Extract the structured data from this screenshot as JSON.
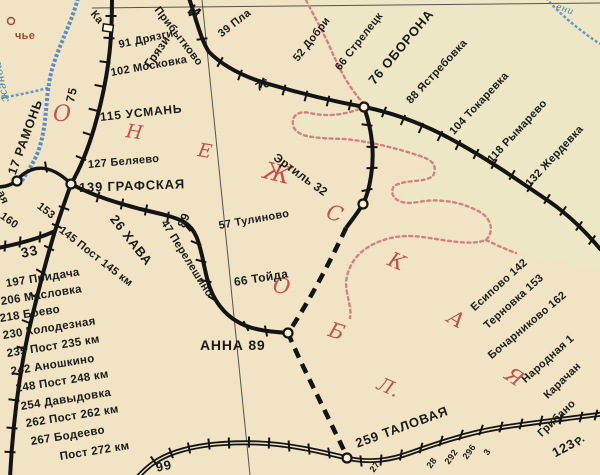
{
  "palette": {
    "background": "#f1e4c4",
    "railway_black": "#141414",
    "oblast_boundary_pink": "#d4827f",
    "river_blue": "#4a84c4",
    "oblast_letters_red": "#c0524e",
    "settlement_red": "#a34a33",
    "neighbor_region_tint": "#e9edcc"
  },
  "map": {
    "description": "Railway map fragment, Voronezh oblast",
    "labels": [
      {
        "t": "О",
        "x": 53,
        "y": 104,
        "r": 0,
        "s": 22,
        "c": "red",
        "n": "oblast-letter"
      },
      {
        "t": "Н",
        "x": 126,
        "y": 122,
        "r": 8,
        "s": 19,
        "c": "red",
        "n": "oblast-letter"
      },
      {
        "t": "Е",
        "x": 198,
        "y": 141,
        "r": 10,
        "s": 19,
        "c": "red",
        "n": "oblast-letter"
      },
      {
        "t": "Ж",
        "x": 264,
        "y": 158,
        "r": 14,
        "s": 24,
        "c": "red",
        "n": "oblast-letter"
      },
      {
        "t": "С",
        "x": 327,
        "y": 201,
        "r": 18,
        "s": 21,
        "c": "red",
        "n": "oblast-letter"
      },
      {
        "t": "К",
        "x": 389,
        "y": 248,
        "r": 24,
        "s": 21,
        "c": "red",
        "n": "oblast-letter"
      },
      {
        "t": "А",
        "x": 449,
        "y": 305,
        "r": 30,
        "s": 21,
        "c": "red",
        "n": "oblast-letter"
      },
      {
        "t": "Я",
        "x": 507,
        "y": 362,
        "r": 34,
        "s": 21,
        "c": "red",
        "n": "oblast-letter"
      },
      {
        "t": "О",
        "x": 273,
        "y": 275,
        "r": 8,
        "s": 21,
        "c": "red",
        "n": "oblast-letter"
      },
      {
        "t": "Б",
        "x": 329,
        "y": 319,
        "r": 18,
        "s": 21,
        "c": "red",
        "n": "oblast-letter"
      },
      {
        "t": "Л.",
        "x": 378,
        "y": 374,
        "r": 24,
        "s": 19,
        "c": "red",
        "n": "oblast-letter"
      },
      {
        "t": "чье",
        "x": 15,
        "y": 31,
        "r": 0,
        "s": 11,
        "c": "brown",
        "n": "settlement-label"
      },
      {
        "t": "ронеж",
        "x": -2,
        "y": 56,
        "r": 78,
        "s": 11,
        "c": "blue",
        "n": "river-label"
      },
      {
        "t": "ени",
        "x": 556,
        "y": 3,
        "r": 18,
        "s": 9,
        "c": "blue",
        "n": "river-label"
      },
      {
        "t": "Прибытково",
        "x": 156,
        "y": 3,
        "r": 52,
        "s": 11,
        "n": "station-label"
      },
      {
        "t": "И",
        "x": 189,
        "y": 1,
        "r": 38,
        "s": 16,
        "b": true,
        "n": "direction-label"
      },
      {
        "t": "Ка",
        "x": 92,
        "y": 7,
        "r": 50,
        "s": 11,
        "n": "direction-label"
      },
      {
        "t": "Грязи",
        "x": 147,
        "y": 60,
        "r": -55,
        "s": 12,
        "n": "direction-label"
      },
      {
        "t": "75",
        "x": 70,
        "y": 96,
        "r": -78,
        "s": 12,
        "b": true,
        "n": "km-marker"
      },
      {
        "t": "91 Дрязги",
        "x": 119,
        "y": 40,
        "r": -12,
        "s": 11,
        "n": "station-label"
      },
      {
        "t": "102 Московка",
        "x": 111,
        "y": 68,
        "r": -10,
        "s": 11,
        "n": "station-label"
      },
      {
        "t": "115 УСМАНЬ",
        "x": 100,
        "y": 111,
        "r": -6,
        "s": 12,
        "b": true,
        "n": "station-label"
      },
      {
        "t": "127 Беляево",
        "x": 88,
        "y": 160,
        "r": -5,
        "s": 11,
        "n": "station-label"
      },
      {
        "t": "139 ГРАФСКАЯ",
        "x": 79,
        "y": 181,
        "r": -2,
        "s": 13,
        "b": true,
        "n": "station-label"
      },
      {
        "t": "17 РАМОНЬ",
        "x": 12,
        "y": 168,
        "r": -70,
        "s": 12.5,
        "b": true,
        "n": "station-label"
      },
      {
        "t": "39 Пла",
        "x": 220,
        "y": 30,
        "r": -38,
        "s": 11,
        "n": "station-label"
      },
      {
        "t": "52 Добри",
        "x": 296,
        "y": 55,
        "r": -52,
        "s": 11,
        "n": "station-label"
      },
      {
        "t": "66 Стрелецк",
        "x": 338,
        "y": 64,
        "r": -52,
        "s": 11,
        "n": "station-label"
      },
      {
        "t": "76",
        "x": 256,
        "y": 82,
        "r": -25,
        "s": 12,
        "b": true,
        "n": "km-marker"
      },
      {
        "t": "76 ОБОРОНА",
        "x": 371,
        "y": 76,
        "r": -50,
        "s": 13,
        "b": true,
        "n": "station-label"
      },
      {
        "t": "88 Ястребовка",
        "x": 409,
        "y": 97,
        "r": -47,
        "s": 11,
        "n": "station-label"
      },
      {
        "t": "104 Токаревка",
        "x": 452,
        "y": 128,
        "r": -47,
        "s": 11,
        "n": "station-label"
      },
      {
        "t": "118 Рымарево",
        "x": 490,
        "y": 156,
        "r": -47,
        "s": 11,
        "n": "station-label"
      },
      {
        "t": "132 Жердевка",
        "x": 528,
        "y": 180,
        "r": -47,
        "s": 11,
        "n": "station-label"
      },
      {
        "t": "Эртиль 32",
        "x": 275,
        "y": 150,
        "r": 36,
        "s": 12,
        "n": "station-label"
      },
      {
        "t": "57 Тулиново",
        "x": 219,
        "y": 221,
        "r": -10,
        "s": 11,
        "n": "station-label"
      },
      {
        "t": "66 Тойда",
        "x": 234,
        "y": 276,
        "r": -9,
        "s": 12,
        "n": "station-label"
      },
      {
        "t": "89",
        "x": 181,
        "y": 221,
        "r": -68,
        "s": 12,
        "b": true,
        "n": "km-marker"
      },
      {
        "t": "26 ХАВА",
        "x": 113,
        "y": 210,
        "r": 52,
        "s": 13,
        "b": true,
        "n": "station-label"
      },
      {
        "t": "47 Перелешино",
        "x": 163,
        "y": 216,
        "r": 58,
        "s": 11,
        "n": "station-label"
      },
      {
        "t": "145 Пост 145 км",
        "x": 60,
        "y": 224,
        "r": 38,
        "s": 11,
        "n": "station-label"
      },
      {
        "t": "153",
        "x": 38,
        "y": 200,
        "r": 38,
        "s": 11,
        "n": "km-marker"
      },
      {
        "t": "160",
        "x": 1,
        "y": 210,
        "r": 36,
        "s": 11,
        "n": "km-marker"
      },
      {
        "t": "ая",
        "x": 0,
        "y": 186,
        "r": 68,
        "s": 11,
        "n": "station-label"
      },
      {
        "t": "33",
        "x": 21,
        "y": 246,
        "r": -12,
        "s": 14,
        "b": true,
        "n": "km-marker"
      },
      {
        "t": "АННА  89",
        "x": 200,
        "y": 338,
        "r": 0,
        "s": 14,
        "b": true,
        "n": "station-label"
      },
      {
        "t": "197 Придача",
        "x": 6,
        "y": 279,
        "r": -9,
        "s": 11.5,
        "n": "station-label"
      },
      {
        "t": "206 Масловка",
        "x": 1,
        "y": 297,
        "r": -9,
        "s": 11.5,
        "n": "station-label"
      },
      {
        "t": "218 Боево",
        "x": 0,
        "y": 314,
        "r": -9,
        "s": 11.5,
        "n": "station-label"
      },
      {
        "t": "230 Колодезная",
        "x": 3,
        "y": 331,
        "r": -9,
        "s": 11.5,
        "n": "station-label"
      },
      {
        "t": "235 Пост 235 км",
        "x": 7,
        "y": 349,
        "r": -9,
        "s": 11.5,
        "n": "station-label"
      },
      {
        "t": "242 Аношкино",
        "x": 11,
        "y": 367,
        "r": -9,
        "s": 11.5,
        "n": "station-label"
      },
      {
        "t": "248 Пост 248 км",
        "x": 16,
        "y": 384,
        "r": -9,
        "s": 11.5,
        "n": "station-label"
      },
      {
        "t": "254 Давыдовка",
        "x": 21,
        "y": 402,
        "r": -9,
        "s": 11.5,
        "n": "station-label"
      },
      {
        "t": "262 Пост 262 км",
        "x": 26,
        "y": 419,
        "r": -9,
        "s": 11.5,
        "n": "station-label"
      },
      {
        "t": "267 Бодеево",
        "x": 31,
        "y": 437,
        "r": -9,
        "s": 11.5,
        "n": "station-label"
      },
      {
        "t": "Пост 272 км",
        "x": 60,
        "y": 452,
        "r": -9,
        "s": 11.5,
        "n": "station-label"
      },
      {
        "t": "99",
        "x": 156,
        "y": 461,
        "r": -12,
        "s": 13,
        "b": true,
        "n": "km-marker"
      },
      {
        "t": "259 ТАЛОВАЯ",
        "x": 356,
        "y": 437,
        "r": -20,
        "s": 13,
        "b": true,
        "n": "station-label"
      },
      {
        "t": "Есипово 142",
        "x": 473,
        "y": 304,
        "r": -42,
        "s": 11,
        "n": "station-label"
      },
      {
        "t": "Терновка 153",
        "x": 486,
        "y": 322,
        "r": -42,
        "s": 11,
        "n": "station-label"
      },
      {
        "t": "Бочарниково 162",
        "x": 490,
        "y": 352,
        "r": -40,
        "s": 11,
        "n": "station-label"
      },
      {
        "t": "Народная 1",
        "x": 524,
        "y": 376,
        "r": -42,
        "s": 11,
        "n": "station-label"
      },
      {
        "t": "Карачан",
        "x": 546,
        "y": 392,
        "r": -44,
        "s": 11,
        "n": "station-label"
      },
      {
        "t": "Грибано",
        "x": 540,
        "y": 430,
        "r": -44,
        "s": 11,
        "n": "station-label"
      },
      {
        "t": "Р.",
        "x": 577,
        "y": 439,
        "r": -44,
        "s": 11,
        "n": "station-label"
      },
      {
        "t": "123",
        "x": 553,
        "y": 447,
        "r": -28,
        "s": 13,
        "b": true,
        "n": "km-marker"
      },
      {
        "t": "28",
        "x": 429,
        "y": 463,
        "r": -55,
        "s": 9,
        "n": "km-marker"
      },
      {
        "t": "292",
        "x": 447,
        "y": 459,
        "r": -55,
        "s": 9,
        "n": "km-marker"
      },
      {
        "t": "296",
        "x": 465,
        "y": 454,
        "r": -55,
        "s": 9,
        "n": "km-marker"
      },
      {
        "t": "3",
        "x": 486,
        "y": 450,
        "r": -55,
        "s": 9,
        "n": "km-marker"
      },
      {
        "t": "27",
        "x": 372,
        "y": 467,
        "r": -55,
        "s": 9,
        "n": "km-marker"
      }
    ]
  }
}
